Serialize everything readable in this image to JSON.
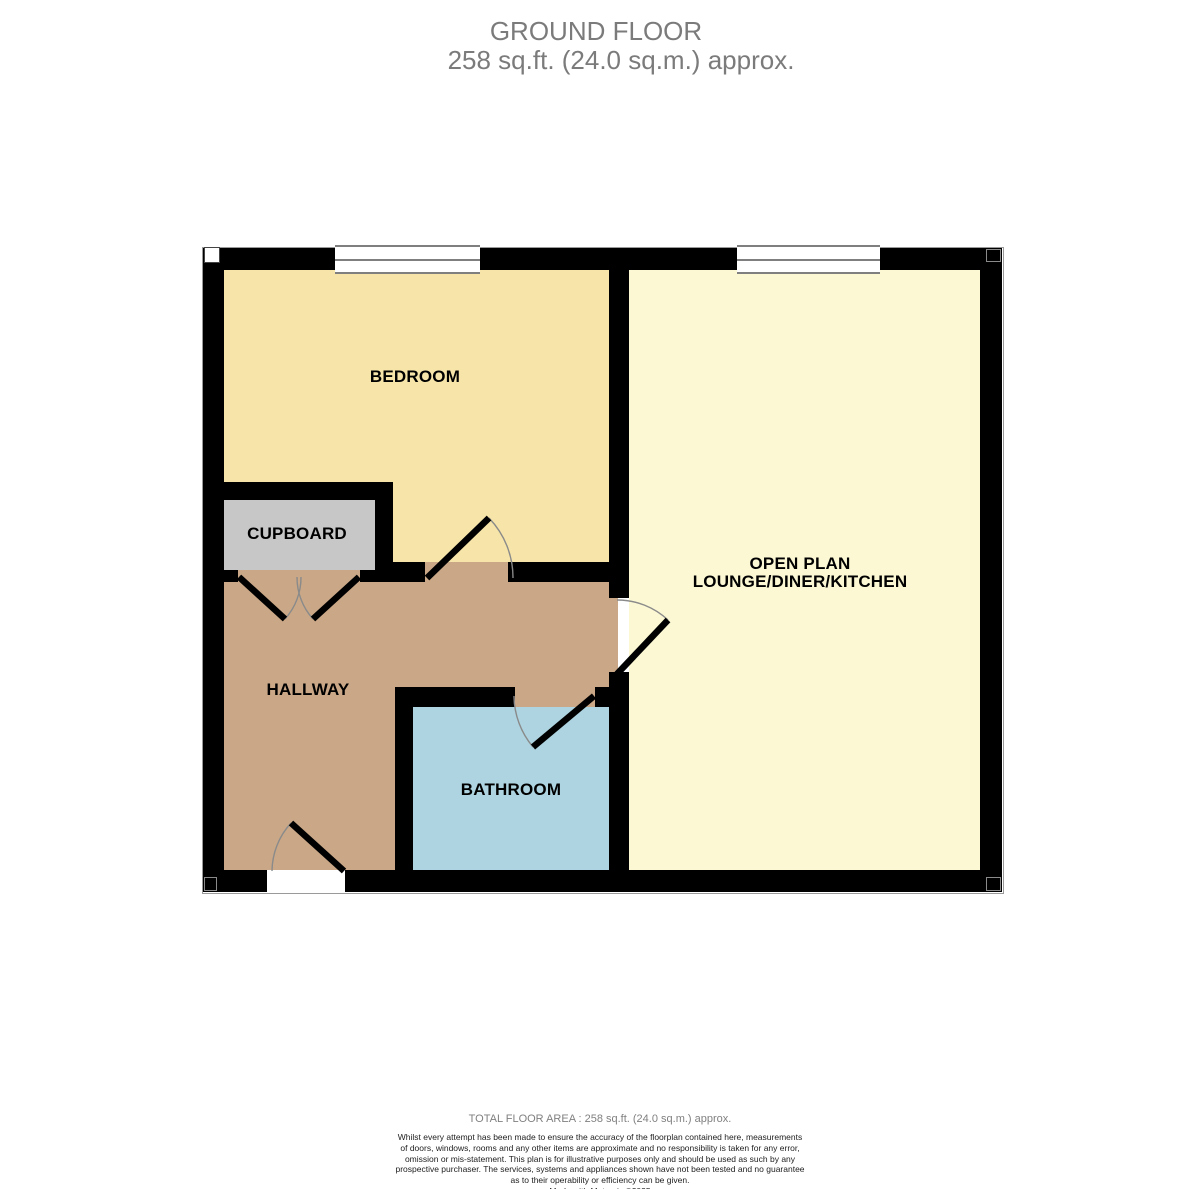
{
  "title": {
    "line1": "GROUND FLOOR",
    "line2": "258 sq.ft. (24.0 sq.m.) approx."
  },
  "floor": "GROUND FLOOR",
  "total_area_value": "258 sq.ft. (24.0 sq.m.)",
  "rooms": {
    "bedroom": {
      "label": "BEDROOM",
      "color": "#f6e4a8"
    },
    "cupboard": {
      "label": "CUPBOARD",
      "color": "#c7c7c7"
    },
    "hallway": {
      "label": "HALLWAY",
      "color": "#caa887"
    },
    "bathroom": {
      "label": "BATHROOM",
      "color": "#add4e0"
    },
    "lounge": {
      "label_line1": "OPEN PLAN",
      "label_line2": "LOUNGE/DINER/KITCHEN",
      "color": "#fbf8d3"
    }
  },
  "colors": {
    "wall": "#000000",
    "window_line": "#7f7f7f",
    "door_arc": "#8a8a8a",
    "title_text": "#7b7b7b",
    "room_label_text": "#000000",
    "footer_area_text": "#808080",
    "disclaimer_text": "#222222",
    "background": "#ffffff"
  },
  "features": {
    "windows": 2,
    "doors": [
      "bedroom-door",
      "cupboard-double-door",
      "front-door",
      "lounge-door",
      "bathroom-door"
    ]
  },
  "footer": {
    "total_area": "TOTAL FLOOR AREA : 258 sq.ft. (24.0 sq.m.) approx.",
    "disclaimer_lines": [
      "Whilst every attempt has been made to ensure the accuracy of the floorplan contained here, measurements",
      "of doors, windows, rooms and any other items are approximate and no responsibility is taken for any error,",
      "omission or mis-statement. This plan is for illustrative purposes only and should be used as such by any",
      "prospective purchaser. The services, systems and appliances shown have not been tested and no guarantee",
      "as to their operability or efficiency can be given."
    ],
    "credit": "Made with Metropix ©2025"
  }
}
